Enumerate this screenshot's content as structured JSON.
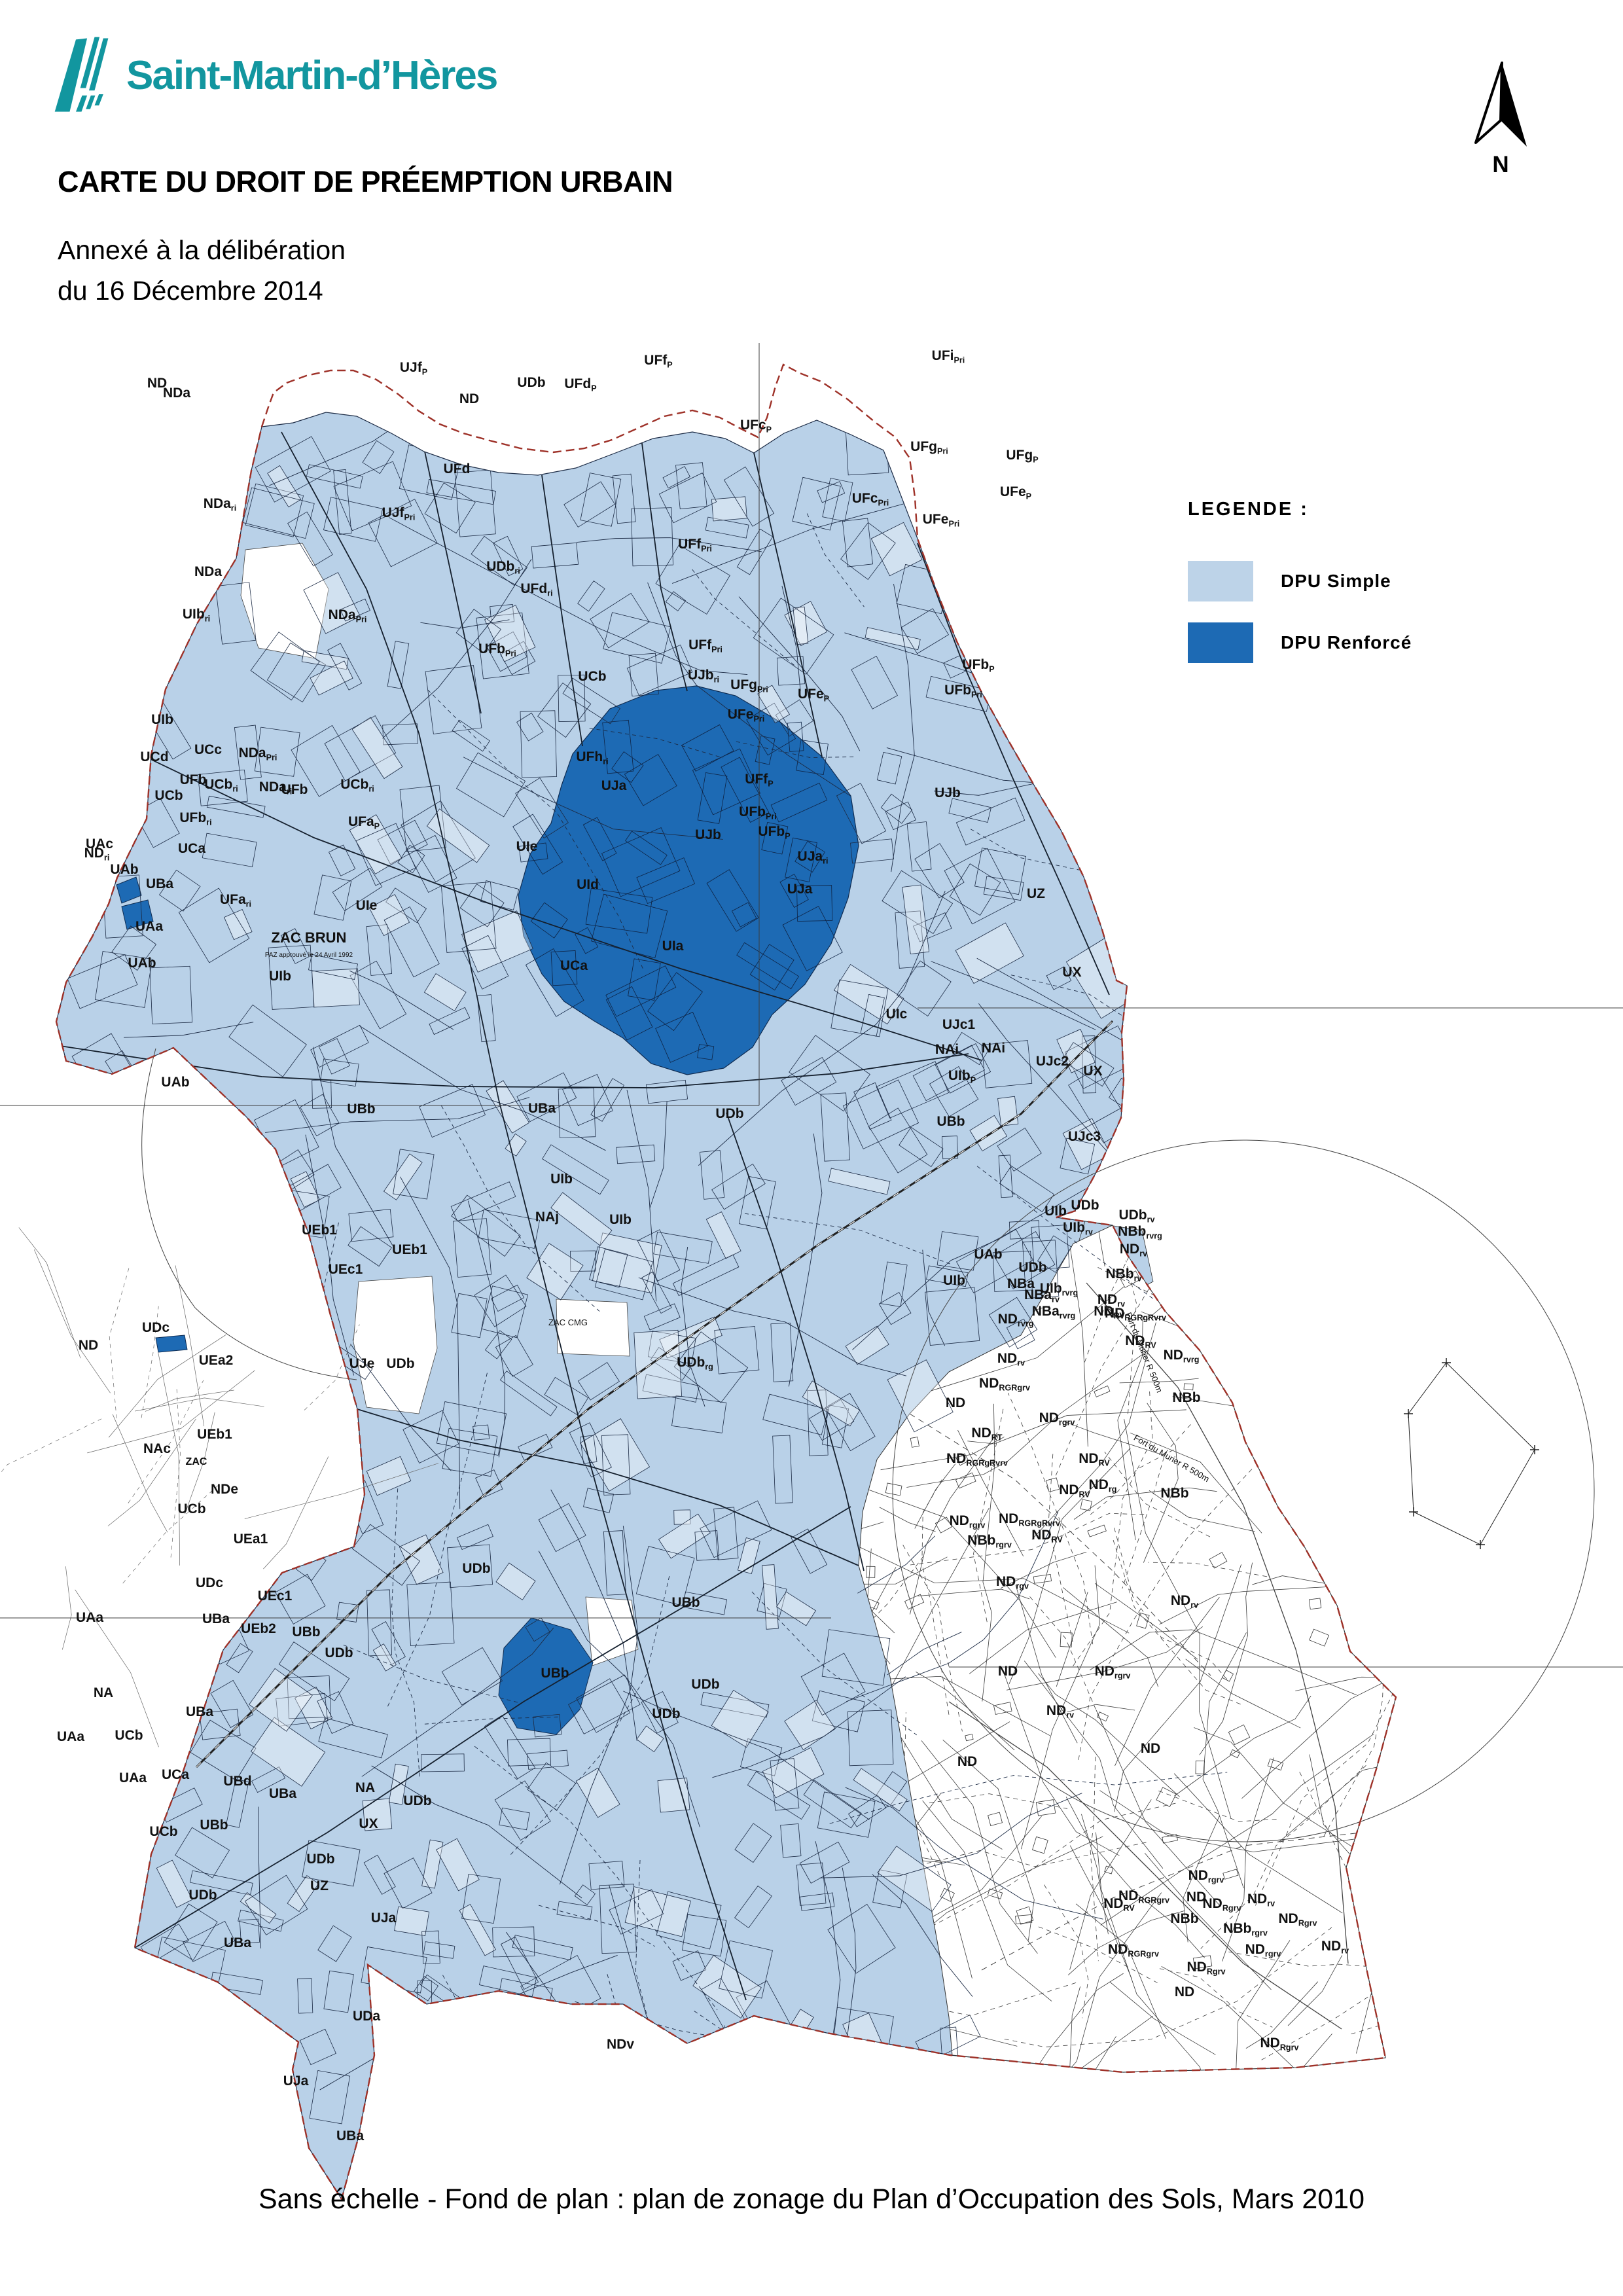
{
  "header": {
    "logo_text": "Saint-Martin-d’Hères",
    "title": "CARTE DU DROIT DE PRÉEMPTION URBAIN",
    "subtitle_line1": "Annexé à la délibération",
    "subtitle_line2": "du 16 Décembre 2014"
  },
  "north": {
    "label": "N"
  },
  "legend": {
    "title": "LEGENDE :",
    "items": [
      {
        "label": "DPU Simple",
        "color": "#bdd3e8"
      },
      {
        "label": "DPU Renforcé",
        "color": "#1d6ab4"
      }
    ]
  },
  "footer": {
    "text": "Sans échelle - Fond de plan : plan de zonage du Plan d’Occupation des Sols, Mars 2010"
  },
  "map": {
    "colors": {
      "dpu_simple": "#b9d1e8",
      "dpu_renforce": "#1d6ab4",
      "boundary": "#9e3128",
      "parcel_line": "#1c2b45",
      "nd_line": "#3a3a3a"
    },
    "labels": [
      [
        "ND",
        "",
        240,
        592
      ],
      [
        "NDa",
        "",
        270,
        607
      ],
      [
        "UJf",
        "P",
        632,
        568
      ],
      [
        "UDb",
        "",
        812,
        591
      ],
      [
        "UFd",
        "P",
        887,
        593
      ],
      [
        "ND",
        "",
        717,
        616
      ],
      [
        "UFf",
        "P",
        1006,
        557
      ],
      [
        "UFi",
        "Pri",
        1449,
        550
      ],
      [
        "UFc",
        "P",
        1155,
        656
      ],
      [
        "UFg",
        "P",
        1562,
        702
      ],
      [
        "UFg",
        "Pri",
        1420,
        689
      ],
      [
        "UFe",
        "P",
        1552,
        758
      ],
      [
        "UFe",
        "Pri",
        1438,
        800
      ],
      [
        "UFc",
        "Pri",
        1330,
        768
      ],
      [
        "NDa",
        "ri",
        336,
        776
      ],
      [
        "UJf",
        "Pri",
        609,
        790
      ],
      [
        "UDb",
        "ri",
        769,
        872
      ],
      [
        "UFd",
        "",
        698,
        723
      ],
      [
        "NDa",
        "",
        318,
        880
      ],
      [
        "UIb",
        "ri",
        300,
        945
      ],
      [
        "UFd",
        "ri",
        820,
        906
      ],
      [
        "UFf",
        "Pri",
        1062,
        838
      ],
      [
        "UFf",
        "Pri",
        1078,
        992
      ],
      [
        "UFb",
        "Pri",
        760,
        998
      ],
      [
        "NDa",
        "Pri",
        531,
        946
      ],
      [
        "UFh",
        "ri",
        905,
        1163
      ],
      [
        "UFb",
        "P",
        1495,
        1022
      ],
      [
        "UFb",
        "Pri",
        1472,
        1061
      ],
      [
        "UCd",
        "",
        236,
        1163
      ],
      [
        "UCb",
        "",
        258,
        1222
      ],
      [
        "UBa",
        "",
        244,
        1357
      ],
      [
        "UIb",
        "",
        248,
        1106
      ],
      [
        "UFb",
        "",
        295,
        1198
      ],
      [
        "UFb",
        "ri",
        299,
        1256
      ],
      [
        "ND",
        "ri",
        148,
        1310
      ],
      [
        "UCc",
        "",
        318,
        1152
      ],
      [
        "UCb",
        "ri",
        338,
        1205
      ],
      [
        "NDa",
        "Pri",
        394,
        1157
      ],
      [
        "NDa",
        "ri",
        421,
        1209
      ],
      [
        "UFb",
        "",
        450,
        1213
      ],
      [
        "UFa",
        "ri",
        360,
        1381
      ],
      [
        "UIb",
        "",
        428,
        1498
      ],
      [
        "UCb",
        "ri",
        546,
        1205
      ],
      [
        "UCb",
        "",
        905,
        1040
      ],
      [
        "UJb",
        "ri",
        1075,
        1038
      ],
      [
        "UFg",
        "Pri",
        1145,
        1053
      ],
      [
        "UFe",
        "P",
        1243,
        1067
      ],
      [
        "UFe",
        "Pri",
        1140,
        1098
      ],
      [
        "UFa",
        "P",
        556,
        1262
      ],
      [
        "UAb",
        "",
        190,
        1335
      ],
      [
        "UAa",
        "",
        228,
        1422
      ],
      [
        "UAb",
        "",
        217,
        1478
      ],
      [
        "UAb",
        "",
        268,
        1660
      ],
      [
        "UAc",
        "",
        152,
        1296
      ],
      [
        "ND",
        "",
        135,
        2062
      ],
      [
        "UIe",
        "",
        805,
        1300
      ],
      [
        "UIe",
        "",
        560,
        1390
      ],
      [
        "UJa",
        "",
        938,
        1207
      ],
      [
        "UJb",
        "",
        1082,
        1282
      ],
      [
        "UId",
        "",
        898,
        1358
      ],
      [
        "UIa",
        "",
        1028,
        1452
      ],
      [
        "UCa",
        "",
        293,
        1303
      ],
      [
        "UCa",
        "",
        877,
        1482
      ],
      [
        "UFf",
        "P",
        1160,
        1197
      ],
      [
        "UFb",
        "Pri",
        1158,
        1247
      ],
      [
        "UFb",
        "P",
        1183,
        1277
      ],
      [
        "UJa",
        "ri",
        1242,
        1315
      ],
      [
        "UJa",
        "",
        1222,
        1365
      ],
      [
        "UJb",
        "",
        1448,
        1218
      ],
      [
        "UZ",
        "",
        1583,
        1372
      ],
      [
        "UX",
        "",
        1638,
        1492
      ],
      [
        "UIc",
        "",
        1370,
        1556
      ],
      [
        "UJc1",
        "",
        1465,
        1572
      ],
      [
        "NAi",
        "",
        1447,
        1610
      ],
      [
        "NAi",
        "",
        1518,
        1608
      ],
      [
        "UJc2",
        "",
        1608,
        1628
      ],
      [
        "UX",
        "",
        1670,
        1643
      ],
      [
        "UJc3",
        "",
        1657,
        1743
      ],
      [
        "UIb",
        "P",
        1470,
        1650
      ],
      [
        "UBb",
        "",
        1453,
        1720
      ],
      [
        "UBb",
        "",
        552,
        1701
      ],
      [
        "UBa",
        "",
        828,
        1700
      ],
      [
        "UDb",
        "",
        1115,
        1708
      ],
      [
        "UIb",
        "",
        858,
        1808
      ],
      [
        "NAj",
        "",
        836,
        1866
      ],
      [
        "UIb",
        "",
        948,
        1870
      ],
      [
        "UEb1",
        "",
        488,
        1886
      ],
      [
        "UEb1",
        "",
        626,
        1916
      ],
      [
        "UEc1",
        "",
        528,
        1946
      ],
      [
        "UJe",
        "",
        553,
        2090
      ],
      [
        "UDb",
        "",
        612,
        2090
      ],
      [
        "ZAC CMG",
        "",
        868,
        2025,
        13
      ],
      [
        "UEa2",
        "",
        330,
        2085
      ],
      [
        "UEb1",
        "",
        328,
        2198
      ],
      [
        "NAc",
        "",
        240,
        2220
      ],
      [
        "ZAC",
        "",
        300,
        2238,
        16
      ],
      [
        "NDe",
        "",
        343,
        2282
      ],
      [
        "UCb",
        "",
        293,
        2312
      ],
      [
        "UEa1",
        "",
        383,
        2358
      ],
      [
        "UEc1",
        "",
        420,
        2445
      ],
      [
        "UDc",
        "",
        320,
        2425
      ],
      [
        "UBa",
        "",
        330,
        2480
      ],
      [
        "UEb2",
        "",
        395,
        2495
      ],
      [
        "UBb",
        "",
        468,
        2500
      ],
      [
        "UDb",
        "",
        518,
        2532
      ],
      [
        "UDc",
        "",
        238,
        2035
      ],
      [
        "UDb",
        "",
        728,
        2403
      ],
      [
        "UBb",
        "",
        1048,
        2455
      ],
      [
        "UDb",
        "",
        1018,
        2625
      ],
      [
        "UBb",
        "",
        848,
        2563
      ],
      [
        "UDb",
        "",
        1078,
        2580
      ],
      [
        "UDb",
        "rg",
        1062,
        2088
      ],
      [
        "NA",
        "",
        558,
        2738
      ],
      [
        "UDb",
        "",
        638,
        2758
      ],
      [
        "UX",
        "",
        563,
        2793
      ],
      [
        "UDb",
        "",
        490,
        2847
      ],
      [
        "UZ",
        "",
        488,
        2888
      ],
      [
        "UJa",
        "",
        586,
        2937
      ],
      [
        "UBa",
        "",
        363,
        2975
      ],
      [
        "UDa",
        "",
        560,
        3087
      ],
      [
        "UJa",
        "",
        452,
        3186
      ],
      [
        "UBa",
        "",
        535,
        3270
      ],
      [
        "UAa",
        "",
        203,
        2723
      ],
      [
        "UCa",
        "",
        268,
        2718
      ],
      [
        "UBd",
        "",
        363,
        2728
      ],
      [
        "UBa",
        "",
        432,
        2747
      ],
      [
        "UBb",
        "",
        327,
        2795
      ],
      [
        "UCb",
        "",
        250,
        2805
      ],
      [
        "UDb",
        "",
        310,
        2902
      ],
      [
        "UAa",
        "",
        137,
        2478
      ],
      [
        "NA",
        "",
        158,
        2593
      ],
      [
        "UAa",
        "",
        108,
        2660
      ],
      [
        "UCb",
        "",
        197,
        2658
      ],
      [
        "UBa",
        "",
        305,
        2622
      ],
      [
        "NDv",
        "",
        948,
        3130
      ],
      [
        "NBa",
        "",
        1560,
        1968
      ],
      [
        "NBa",
        "rv",
        1592,
        1985
      ],
      [
        "NBa",
        "rvrg",
        1610,
        2010
      ],
      [
        "UIb",
        "rvrg",
        1618,
        1975
      ],
      [
        "UDb",
        "",
        1578,
        1943
      ],
      [
        "UIb",
        "",
        1458,
        1963
      ],
      [
        "UAb",
        "",
        1510,
        1923
      ],
      [
        "UDb",
        "",
        1658,
        1848
      ],
      [
        "UIb",
        "",
        1613,
        1857
      ],
      [
        "UIb",
        "rv",
        1647,
        1882
      ],
      [
        "UDb",
        "rv",
        1737,
        1863
      ],
      [
        "NBb",
        "rvrg",
        1742,
        1888
      ],
      [
        "ND",
        "rv",
        1732,
        1915
      ],
      [
        "NBb",
        "rv",
        1717,
        1953
      ],
      [
        "ND",
        "rv",
        1698,
        1992
      ],
      [
        "ND",
        "rvrg",
        1552,
        2022
      ],
      [
        "ND",
        "RV",
        1695,
        2010
      ],
      [
        "ND",
        "RGRgRvrv",
        1735,
        2013
      ],
      [
        "ND",
        "RV",
        1743,
        2055
      ],
      [
        "ND",
        "rvrg",
        1805,
        2077
      ],
      [
        "NBb",
        "",
        1813,
        2142
      ],
      [
        "ND",
        "rv",
        1545,
        2082
      ],
      [
        "ND",
        "RGRgrv",
        1535,
        2120
      ],
      [
        "ND",
        "",
        1460,
        2150
      ],
      [
        "ND",
        "rgrv",
        1615,
        2173
      ],
      [
        "ND",
        "RT",
        1508,
        2196
      ],
      [
        "ND",
        "RGRgRvrv",
        1493,
        2235
      ],
      [
        "ND",
        "RV",
        1672,
        2235
      ],
      [
        "ND",
        "rg",
        1685,
        2275
      ],
      [
        "ND",
        "RV",
        1642,
        2283
      ],
      [
        "NBb",
        "",
        1795,
        2288
      ],
      [
        "ND",
        "rgrv",
        1478,
        2330
      ],
      [
        "NBb",
        "rgrv",
        1512,
        2360
      ],
      [
        "ND",
        "RGRgRvrv",
        1573,
        2327
      ],
      [
        "ND",
        "RV",
        1600,
        2352
      ],
      [
        "ND",
        "rgv",
        1547,
        2423
      ],
      [
        "ND",
        "rv",
        1810,
        2452
      ],
      [
        "ND",
        "",
        1540,
        2560
      ],
      [
        "ND",
        "rv",
        1620,
        2620
      ],
      [
        "ND",
        "",
        1478,
        2698
      ],
      [
        "ND",
        "rgrv",
        1700,
        2560
      ],
      [
        "ND",
        "",
        1758,
        2678
      ],
      [
        "ND",
        "rgrv",
        1843,
        2872
      ],
      [
        "ND",
        "RGRgrv",
        1748,
        2903
      ],
      [
        "ND",
        "RV",
        1710,
        2915
      ],
      [
        "ND",
        "",
        1828,
        2905
      ],
      [
        "NBb",
        "",
        1810,
        2938
      ],
      [
        "ND",
        "Rgrv",
        1867,
        2915
      ],
      [
        "ND",
        "rv",
        1927,
        2908
      ],
      [
        "NBb",
        "rgrv",
        1903,
        2953
      ],
      [
        "ND",
        "Rgrv",
        1983,
        2938
      ],
      [
        "ND",
        "rgrv",
        1930,
        2985
      ],
      [
        "ND",
        "Rgrv",
        1843,
        3012
      ],
      [
        "ND",
        "RGRgrv",
        1732,
        2985
      ],
      [
        "ND",
        "",
        1810,
        3050
      ],
      [
        "ND",
        "Rgrv",
        1955,
        3128
      ],
      [
        "ND",
        "rv",
        2040,
        2980
      ],
      [
        "ZAC BRUN",
        "",
        472,
        1440,
        22
      ],
      [
        "PAZ approuvé le 24 Avril 1992",
        "",
        472,
        1462,
        10
      ],
      [
        "Fort du Murier R 500m",
        "",
        1744,
        2068,
        13,
        68
      ],
      [
        "Fort du Murier R 500m",
        "",
        1788,
        2232,
        13,
        30
      ]
    ]
  }
}
